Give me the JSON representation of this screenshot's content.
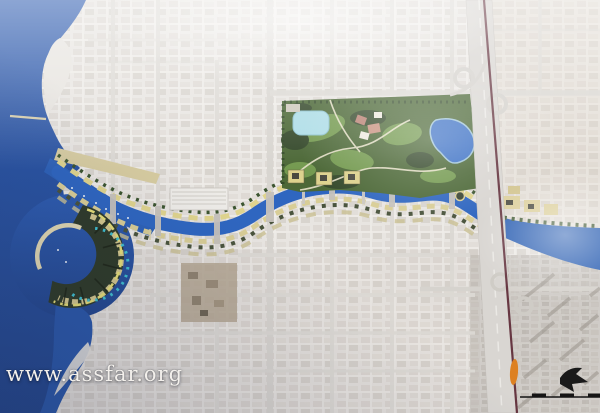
{
  "watermark": {
    "text": "www.assfar.org"
  },
  "map": {
    "description": "Aerial photograph of a city master plan: a blue water canal winds from the sea (left) past a crescent-shaped island development, along mixed-use waterfront strips and a large landscaped park with a lake, under a diagonal highway, joining a wide creek at the right edge.",
    "features": {
      "sea": "sea",
      "crescent_island": "crescent-island-development",
      "canal": "water-canal",
      "canal_mouth": "canal-sea-entrance",
      "park": "central-park",
      "park_lake": "park-lake",
      "park_pond": "park-pond",
      "waterfront_strips": "canal-bank-development",
      "highway": "diagonal-highway",
      "metro_line": "transit-line",
      "station_marker": "orange-station-marker",
      "creek": "creek-east",
      "city_fabric": "aerial-city-blocks"
    },
    "colors": {
      "sea": "#2a55a6",
      "canal": "#2f66c0",
      "park_green": "#4c6837",
      "lake": "#3b70c5",
      "pond": "#aedde7",
      "beach": "#d7cda1",
      "bank_buildings": "#e0d586",
      "highway": "#d9d6d2",
      "metro_line": "#5a2632",
      "station_marker": "#dd8122",
      "city_light": "#e9e6e2",
      "city_dark": "#c8c4bf"
    }
  },
  "legend": {
    "north_arrow": "north-arrow",
    "scale_bar": "scale-bar"
  }
}
